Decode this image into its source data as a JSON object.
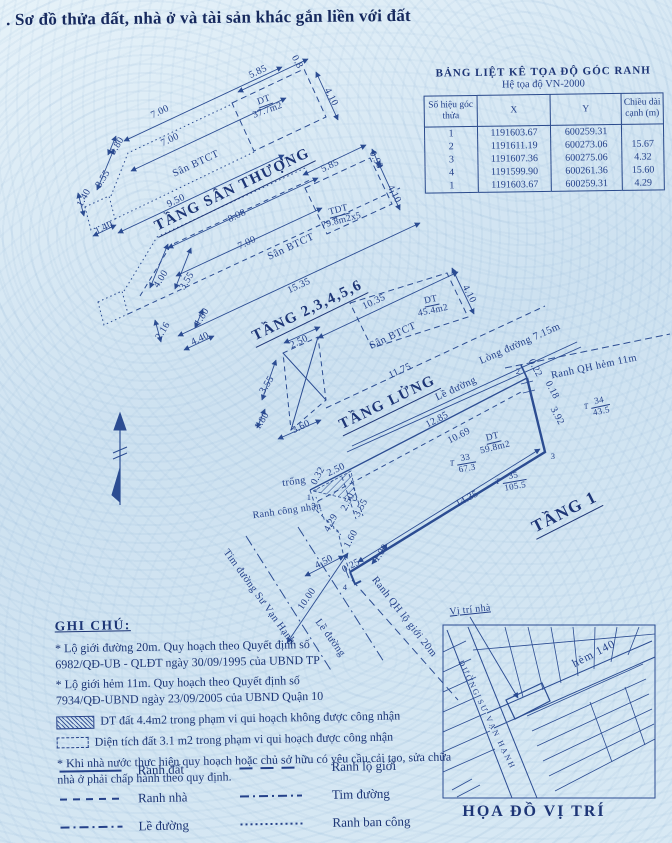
{
  "colors": {
    "ink": "#24418a",
    "paper": "#d3e5f2"
  },
  "title": ". Sơ đồ thửa đất, nhà ở và tài sản khác gắn liền với đất",
  "coord_table": {
    "title": "BẢNG LIỆT KÊ TỌA ĐỘ GÓC RANH",
    "subtitle": "Hệ tọa độ VN-2000",
    "col_id": "Số hiệu góc thửa",
    "col_x": "X",
    "col_y": "Y",
    "col_len": "Chiều dài cạnh (m)",
    "rows": [
      {
        "id": "1",
        "x": "1191603.67",
        "y": "600259.31",
        "len": ""
      },
      {
        "id": "2",
        "x": "1191611.19",
        "y": "600273.06",
        "len": "15.67"
      },
      {
        "id": "3",
        "x": "1191607.36",
        "y": "600275.06",
        "len": "4.32"
      },
      {
        "id": "4",
        "x": "1191599.90",
        "y": "600261.36",
        "len": "15.60"
      },
      {
        "id": "1",
        "x": "1191603.67",
        "y": "600259.31",
        "len": "4.29"
      }
    ]
  },
  "plans": {
    "roof": {
      "label": "TẦNG SÂN THƯỢNG",
      "san": "Sân BTCT",
      "area_num": "DT",
      "area_val": "37.7m2",
      "dims": {
        "top": "5.85",
        "r_small": "0.8",
        "right": "4.10",
        "w1": "7.00",
        "w2": "7.00",
        "slant": "3.55",
        "slant_small": "0.80",
        "sq_left": "1.40",
        "sq_bottom": "1.40",
        "bottom": "9.50"
      }
    },
    "mid": {
      "label": "TẦNG 2,3,4,5,6",
      "san": "Sân BTCT",
      "tdt_num": "TDT",
      "tdt_val": "79.8m2x5",
      "area_num": "DT",
      "area_val": "45.4m2",
      "dims": {
        "top": "8.08",
        "inner": "7.00",
        "rect_top": "5.85",
        "rect_small": "0.90",
        "rect_right": "4.10",
        "slant_out": "4.00",
        "slant_in": "3.55",
        "sq": "1.80",
        "left": "2.16",
        "bottom_small": "4.40",
        "bottom": "15.35",
        "right_bottom": "10.35",
        "rect2_right": "4.10"
      }
    },
    "mezz": {
      "label": "TẦNG LỬNG",
      "san": "Sân BTCT",
      "dims": {
        "top": "2.50",
        "left": "3.55",
        "bottom": "3.60",
        "small": "1.80",
        "edge": "11.75"
      }
    },
    "ground": {
      "label": "TẦNG 1",
      "area_num": "DT",
      "area_val": "59.8m2",
      "trong": "trống",
      "ranh_cn": "Ranh công nhận",
      "corners": {
        "c1": "1",
        "c2": "2",
        "c3": "3",
        "c4": "4"
      },
      "dims": {
        "top": "12.85",
        "inner": "10.69",
        "bottom": "14.35",
        "r1": "0.22",
        "r2": "0.18",
        "r3": "3.92",
        "l1": "0.32",
        "l2": "2.50",
        "l3": "2.50",
        "l4": "3.55",
        "l5": "4.29",
        "l6": "1.60",
        "l7": "1.00",
        "b1": "4.50",
        "b2": "0.25",
        "b3": "10.00"
      }
    }
  },
  "streets": {
    "long_duong": "Lòng đường 7.15m",
    "ranh_hem": "Ranh QH hẻm 11m",
    "le_duong": "Lề đường",
    "le_duong2": "Lề đường",
    "tim_duong": "Tim đường Sư Vạn Hạnh",
    "ranh_lo_gioi": "Ranh QH lộ giới 20m"
  },
  "parcels": {
    "t33": {
      "t": "T",
      "no": "33",
      "area": "67.3"
    },
    "t34": {
      "t": "T",
      "no": "34",
      "area": "43.5"
    },
    "t35": {
      "t": "T",
      "no": "35",
      "area": "105.5"
    }
  },
  "notes": {
    "heading": "GHI CHÚ:",
    "l1a": "* Lộ giới đường   20m. Quy hoạch theo Quyết định số",
    "l1b": "6982/QĐ-UB - QLĐT ngày 30/09/1995 của UBND TP",
    "l2a": "* Lộ giới hẻm   11m. Quy hoạch theo Quyết định số",
    "l2b": "7934/QĐ-UBND ngày 23/09/2005 của UBND Quận 10",
    "hatch": "DT đất 4.4m2  trong phạm vi qui hoạch không được công nhận",
    "dot": "Diện tích đất 3.1 m2  trong phạm vi qui hoạch được công nhận",
    "l5a": "* Khi nhà nước thực hiện quy hoạch hoặc chủ sở hữu có yêu cầu cải tạo, sửa chữa",
    "l5b": "nhà ở phải chấp hành theo quy định."
  },
  "legend": {
    "ranh_dat": "Ranh đất",
    "ranh_nha": "Ranh nhà",
    "le_duong": "Lề đường",
    "ranh_lo_gioi": "Ranh lộ giới",
    "tim_duong": "Tim đường",
    "ranh_ban_cong": "Ranh ban công"
  },
  "map": {
    "location": "Vị trí nhà",
    "hem": "hẻm 140",
    "street": "ĐƯỜNG SƯ VẠN HẠNH",
    "title": "HỌA ĐỒ VỊ TRÍ"
  }
}
